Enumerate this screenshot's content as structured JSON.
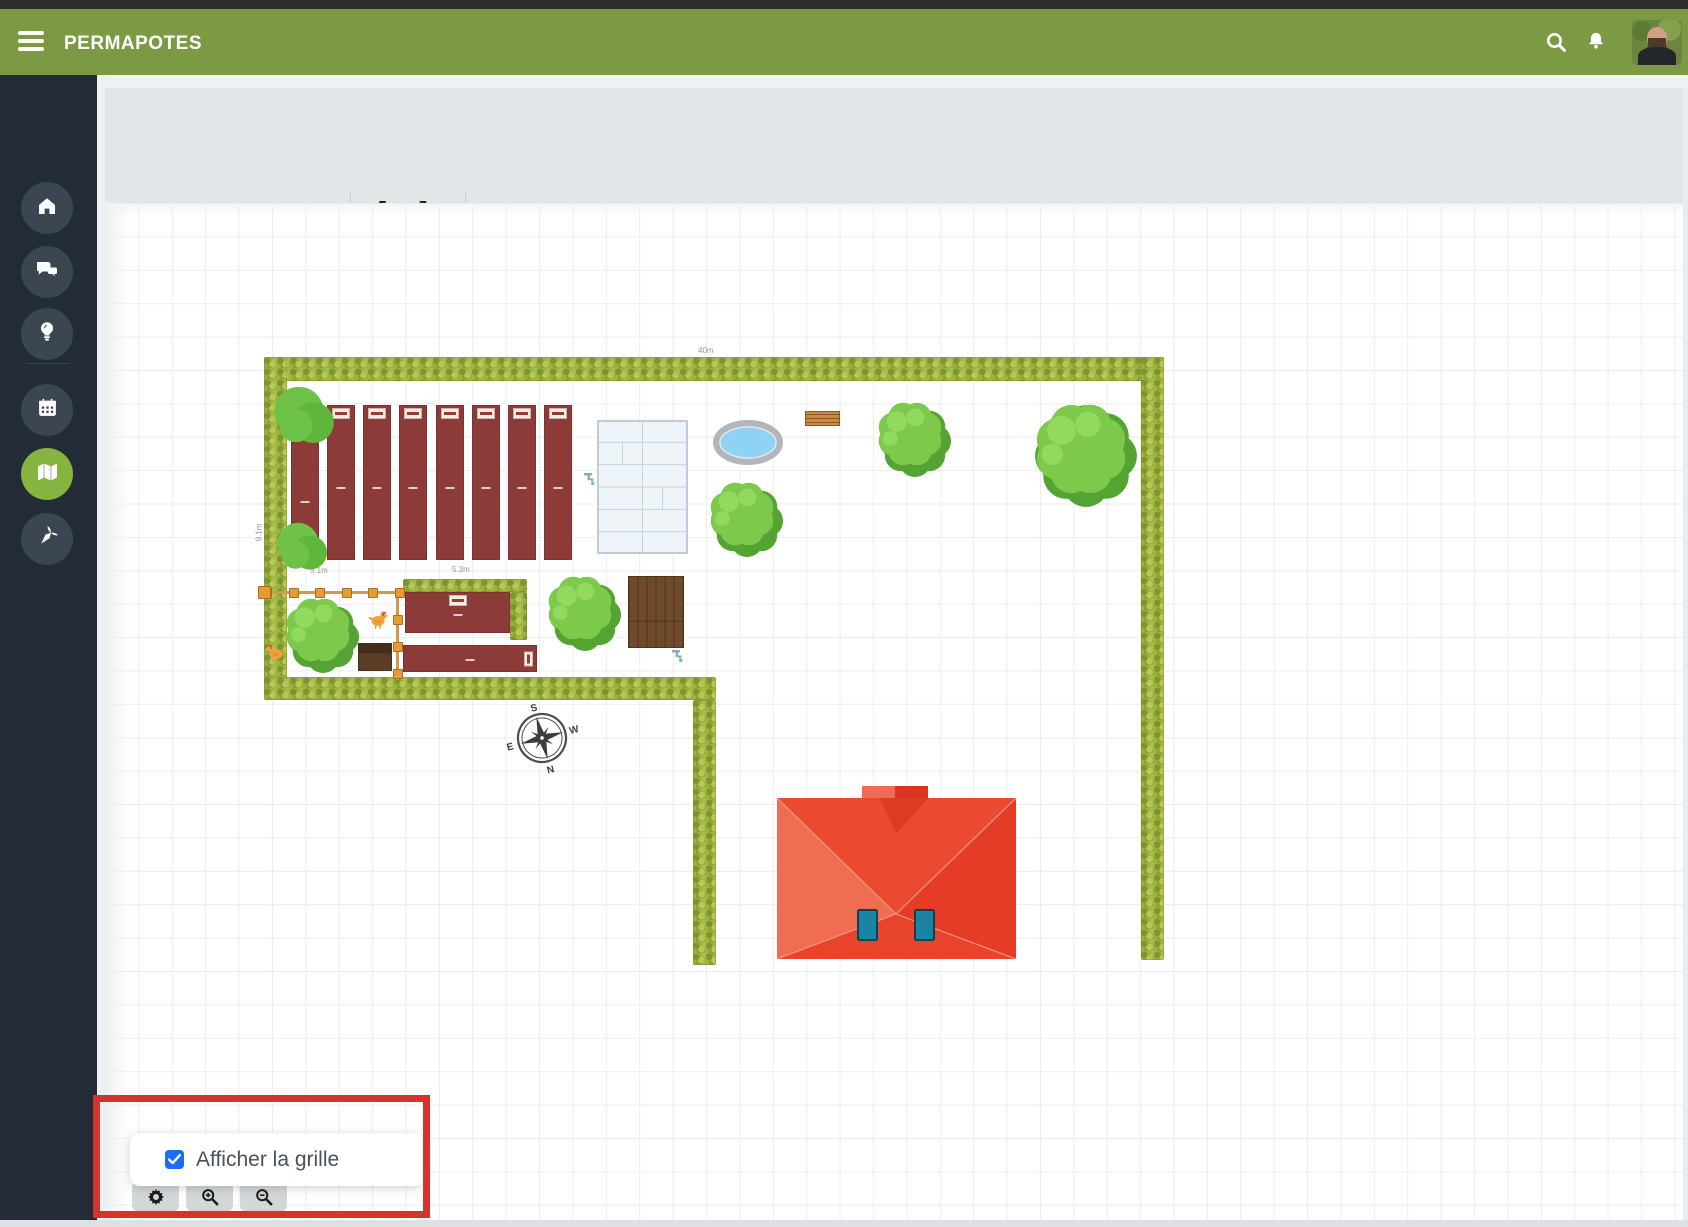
{
  "header": {
    "title": "PERMAPOTES"
  },
  "sidebar": {
    "items": [
      {
        "id": "home",
        "icon": "home-icon",
        "active": false
      },
      {
        "id": "messages",
        "icon": "chat-icon",
        "active": false
      },
      {
        "id": "ideas",
        "icon": "lightbulb-icon",
        "active": false
      },
      {
        "id": "calendar",
        "icon": "calendar-icon",
        "active": false
      },
      {
        "id": "map",
        "icon": "map-icon",
        "active": true
      },
      {
        "id": "garden",
        "icon": "carrot-icon",
        "active": false
      }
    ]
  },
  "toolbar": {
    "save_label": "Enregistrer",
    "undo_glyph": "↺",
    "redo_glyph": "↻",
    "text_tool_glyph": "A",
    "overflow_glyph": "•••"
  },
  "popup": {
    "label": "Afficher la grille",
    "checked": true
  },
  "compass": {
    "points": [
      "S",
      "W",
      "N",
      "E"
    ]
  },
  "colors": {
    "header_green": "#7c9a44",
    "sidebar_dark": "#232c36",
    "active_green": "#85b440",
    "bed_maroon": "#8d3b38",
    "annotation_red": "#d63230",
    "checkbox_blue": "#1b6ef3"
  },
  "canvas": {
    "labels": [
      {
        "text": "40m",
        "x": 698,
        "y": 346,
        "rot": 0
      },
      {
        "text": "9.1m",
        "x": 250,
        "y": 528,
        "rot": -90
      },
      {
        "text": "5.1m",
        "x": 310,
        "y": 566,
        "rot": 0
      },
      {
        "text": "5.3m",
        "x": 452,
        "y": 565,
        "rot": 0
      }
    ],
    "objects": [
      {
        "t": "hedge",
        "name": "hedge-top",
        "x": 264,
        "y": 357,
        "w": 900,
        "h": 24
      },
      {
        "t": "hedge",
        "name": "hedge-left",
        "x": 264,
        "y": 357,
        "w": 23,
        "h": 343
      },
      {
        "t": "hedge",
        "name": "hedge-right",
        "x": 1141,
        "y": 357,
        "w": 23,
        "h": 603
      },
      {
        "t": "hedge",
        "name": "hedge-inner-bottom",
        "x": 264,
        "y": 677,
        "w": 452,
        "h": 23
      },
      {
        "t": "hedge",
        "name": "hedge-inner-vertical",
        "x": 693,
        "y": 700,
        "w": 23,
        "h": 265
      },
      {
        "t": "hedge",
        "name": "hedge-run-top",
        "x": 403,
        "y": 579,
        "w": 124,
        "h": 13
      },
      {
        "t": "hedge",
        "name": "hedge-run-right",
        "x": 510,
        "y": 592,
        "w": 17,
        "h": 48
      },
      {
        "t": "bed",
        "name": "garden-bed-1",
        "x": 291,
        "y": 435,
        "w": 28,
        "h": 125,
        "chip": ""
      },
      {
        "t": "bed",
        "name": "garden-bed-2",
        "x": 327,
        "y": 405,
        "w": 28,
        "h": 155,
        "chip": "top"
      },
      {
        "t": "bed",
        "name": "garden-bed-3",
        "x": 363,
        "y": 405,
        "w": 28,
        "h": 155,
        "chip": "top"
      },
      {
        "t": "bed",
        "name": "garden-bed-4",
        "x": 399,
        "y": 405,
        "w": 28,
        "h": 155,
        "chip": "top"
      },
      {
        "t": "bed",
        "name": "garden-bed-5",
        "x": 436,
        "y": 405,
        "w": 28,
        "h": 155,
        "chip": "top"
      },
      {
        "t": "bed",
        "name": "garden-bed-6",
        "x": 472,
        "y": 405,
        "w": 28,
        "h": 155,
        "chip": "top"
      },
      {
        "t": "bed",
        "name": "garden-bed-7",
        "x": 508,
        "y": 405,
        "w": 28,
        "h": 155,
        "chip": "top"
      },
      {
        "t": "bed",
        "name": "garden-bed-8",
        "x": 544,
        "y": 405,
        "w": 28,
        "h": 155,
        "chip": "top"
      },
      {
        "t": "bed",
        "name": "garden-bed-h1",
        "x": 405,
        "y": 592,
        "w": 105,
        "h": 41,
        "chip": "top"
      },
      {
        "t": "bed",
        "name": "garden-bed-h2",
        "x": 403,
        "y": 645,
        "w": 134,
        "h": 27,
        "chip": "right"
      },
      {
        "t": "greenhouse",
        "name": "greenhouse",
        "x": 597,
        "y": 420,
        "w": 91,
        "h": 134
      },
      {
        "t": "pond",
        "name": "pond",
        "x": 712,
        "y": 419,
        "w": 72,
        "h": 47
      },
      {
        "t": "bench",
        "name": "bench",
        "x": 805,
        "y": 411,
        "w": 35,
        "h": 15
      },
      {
        "t": "shed",
        "name": "shed",
        "x": 628,
        "y": 576,
        "w": 56,
        "h": 72
      },
      {
        "t": "coop",
        "name": "chicken-coop",
        "x": 358,
        "y": 643,
        "w": 34,
        "h": 28
      },
      {
        "t": "fence",
        "name": "chicken-run-fence",
        "x": 262,
        "y": 588,
        "w": 140,
        "h": 92
      },
      {
        "t": "tree",
        "name": "tree-top-left",
        "cx": 305,
        "cy": 416,
        "r": 30,
        "style": "round"
      },
      {
        "t": "tree",
        "name": "tree-left-lower",
        "cx": 303,
        "cy": 547,
        "r": 25,
        "style": "round"
      },
      {
        "t": "tree",
        "name": "tree-below-pond",
        "cx": 744,
        "cy": 517,
        "r": 34,
        "style": "fluffy"
      },
      {
        "t": "tree",
        "name": "tree-middle",
        "cx": 912,
        "cy": 437,
        "r": 34,
        "style": "fluffy"
      },
      {
        "t": "tree",
        "name": "tree-large-right",
        "cx": 1083,
        "cy": 452,
        "r": 48,
        "style": "fluffy"
      },
      {
        "t": "tree",
        "name": "tree-chicken-run",
        "cx": 320,
        "cy": 633,
        "r": 34,
        "style": "fluffy"
      },
      {
        "t": "tree",
        "name": "tree-near-shed",
        "cx": 582,
        "cy": 611,
        "r": 34,
        "style": "fluffy"
      },
      {
        "t": "chicken",
        "name": "chicken-1",
        "x": 368,
        "y": 608,
        "flip": false
      },
      {
        "t": "chicken",
        "name": "chicken-2",
        "x": 264,
        "y": 641,
        "flip": true
      },
      {
        "t": "house",
        "name": "house",
        "x": 777,
        "y": 786,
        "w": 239,
        "h": 173
      },
      {
        "t": "compass",
        "name": "compass-rose",
        "cx": 542,
        "cy": 738,
        "r": 27
      },
      {
        "t": "faucet",
        "name": "faucet-greenhouse",
        "x": 583,
        "y": 470
      },
      {
        "t": "faucet",
        "name": "faucet-shed",
        "x": 671,
        "y": 647
      }
    ]
  }
}
